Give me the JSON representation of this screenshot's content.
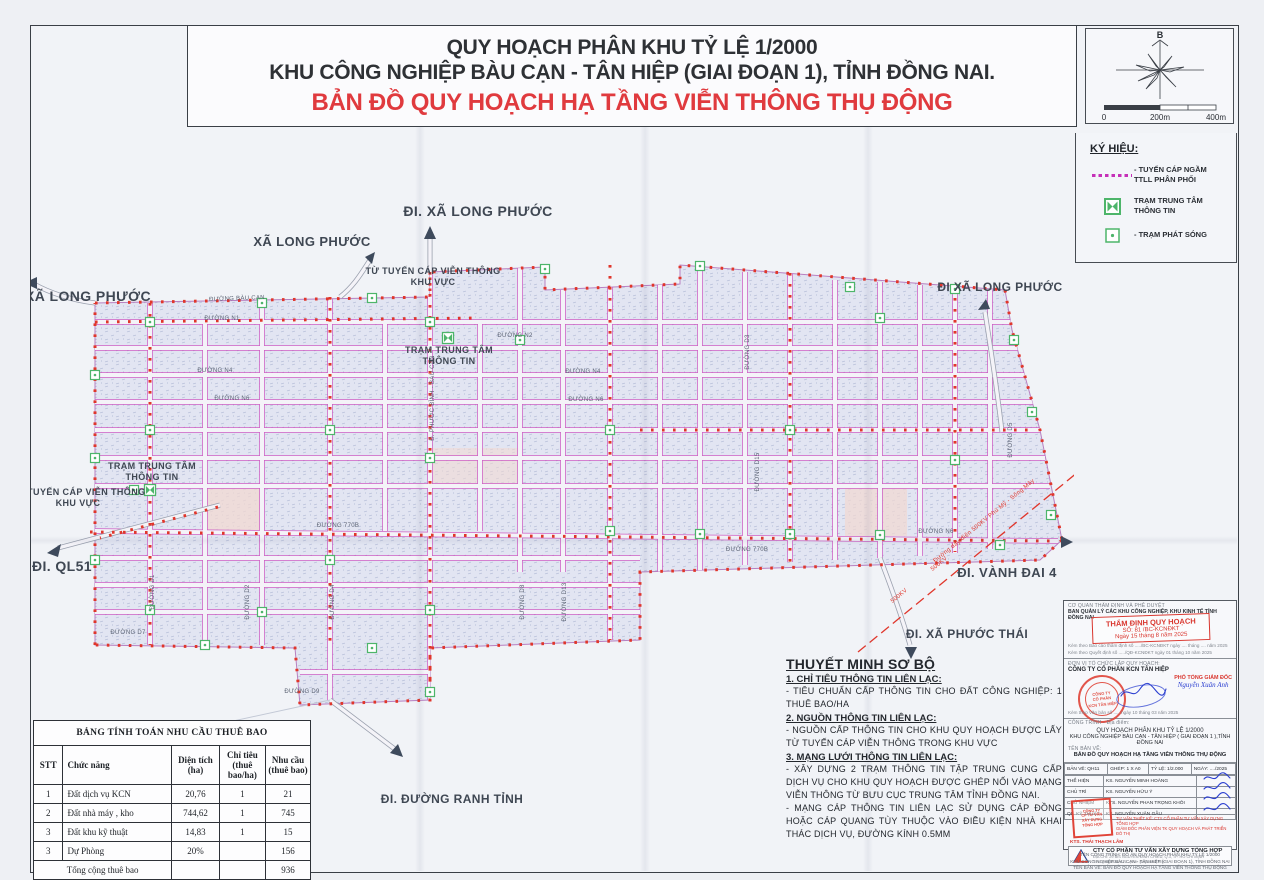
{
  "header": {
    "line1": "QUY HOẠCH PHÂN KHU TỶ LỆ 1/2000",
    "line2": "KHU CÔNG NGHIỆP BÀU CẠN - TÂN HIỆP (GIAI ĐOẠN 1), TỈNH ĐỒNG NAI.",
    "line3": "BẢN ĐỒ QUY HOẠCH HẠ TẦNG VIỄN THÔNG THỤ ĐỘNG"
  },
  "compass": {
    "north": "B",
    "scale0": "0",
    "scale1": "200m",
    "scale2": "400m"
  },
  "legend": {
    "title": "KÝ HIỆU:",
    "item0": "- TUYẾN CÁP NGẦM\nTTLL PHÂN PHỐI",
    "item1": "TRẠM TRUNG TÂM\nTHÔNG TIN",
    "item2": "- TRẠM PHÁT SÓNG"
  },
  "map": {
    "labels": [
      {
        "t": "ĐI. XÃ LONG PHƯỚC"
      },
      {
        "t": "XÃ LONG PHƯỚC"
      },
      {
        "t": "XÃ LONG PHƯỚC"
      },
      {
        "t": "TỪ TUYẾN CÁP VIỄN THÔNG"
      },
      {
        "t": "KHU VỰC"
      },
      {
        "t": "TRẠM TRUNG TÂM"
      },
      {
        "t": "THÔNG TIN"
      },
      {
        "t": "TRẠM TRUNG TÂM"
      },
      {
        "t": "THÔNG TIN"
      },
      {
        "t": "TỪ TUYẾN CÁP VIỄN THÔNG"
      },
      {
        "t": "KHU VỰC"
      },
      {
        "t": "ĐI. QL51"
      },
      {
        "t": "ĐI XÃ LONG PHƯỚC"
      },
      {
        "t": "ĐI. VÀNH ĐAI 4"
      },
      {
        "t": "ĐI. XÃ PHƯỚC THÁI"
      },
      {
        "t": "ĐI. ĐƯỜNG RANH TỈNH"
      }
    ],
    "roads": [
      {
        "t": "ĐƯỜNG BÀU CẠN"
      },
      {
        "t": "ĐƯỜNG N1"
      },
      {
        "t": "ĐƯỜNG N4"
      },
      {
        "t": "ĐƯỜNG N6"
      },
      {
        "t": "ĐƯỜNG N2"
      },
      {
        "t": "ĐƯỜNG N4"
      },
      {
        "t": "ĐƯỜNG N6"
      },
      {
        "t": "ĐƯỜNG 770B"
      },
      {
        "t": "ĐƯỜNG 770B"
      },
      {
        "t": "ĐƯỜNG N6"
      },
      {
        "t": "ĐƯỜNG D7"
      },
      {
        "t": "ĐƯỜNG D9"
      },
      {
        "t": "ĐƯỜNG D1"
      },
      {
        "t": "ĐƯỜNG D2"
      },
      {
        "t": "ĐƯỜNG D4"
      },
      {
        "t": "Đ. PHƯỚC BÌNH - BÀU CẠN"
      },
      {
        "t": "ĐƯỜNG D8"
      },
      {
        "t": "ĐƯỜNG D13"
      },
      {
        "t": "ĐƯỜNG D15"
      },
      {
        "t": "ĐƯỜNG D3"
      },
      {
        "t": "ĐƯỜNG D5"
      }
    ],
    "power": [
      {
        "t": "Đường dây điện 500KV Phú Mỹ - Sông Mây"
      },
      {
        "t": "500KV"
      },
      {
        "t": "500KV"
      }
    ]
  },
  "demand_table": {
    "title": "BẢNG TÍNH TOÁN NHU CẦU THUÊ BAO",
    "h0": "STT",
    "h1": "Chức năng",
    "h2": "Diện tích\n(ha)",
    "h3": "Chỉ tiêu\n(thuê\nbao/ha)",
    "h4": "Nhu cầu\n(thuê bao)",
    "rows": [
      [
        "1",
        "Đất dịch vụ KCN",
        "20,76",
        "1",
        "21"
      ],
      [
        "2",
        "Đất nhà máy , kho",
        "744,62",
        "1",
        "745"
      ],
      [
        "3",
        "Đất khu kỹ thuật",
        "14,83",
        "1",
        "15"
      ],
      [
        "3",
        "Dự Phòng",
        "20%",
        "",
        "156"
      ]
    ],
    "total_label": "Tổng cộng thuê bao",
    "total_value": "936"
  },
  "notes": {
    "title": "THUYẾT MINH SƠ BỘ",
    "s1h": "1. CHỈ TIÊU THÔNG TIN LIÊN LẠC:",
    "s1b": "- TIÊU CHUẨN CẤP THÔNG TIN CHO ĐẤT CÔNG NGHIỆP: 1 THUÊ BAO/HA",
    "s2h": "2. NGUỒN THÔNG TIN LIÊN LẠC:",
    "s2b": "- NGUỒN CẤP THÔNG TIN CHO KHU QUY HOẠCH ĐƯỢC LẤY TỪ TUYẾN CÁP VIỄN THÔNG TRONG KHU VỰC",
    "s3h": "3. MẠNG LƯỚI THÔNG TIN LIÊN LẠC:",
    "s3b1": "- XÂY DỰNG 2 TRẠM THÔNG TIN  TẬP TRUNG  CUNG CẤP DỊCH VỤ CHO KHU QUY HOẠCH ĐƯỢC GHÉP NỐI VÀO MẠNG VIỄN THÔNG TỪ BƯU CỤC TRUNG TÂM TỈNH ĐỒNG NAI.",
    "s3b2": "- MẠNG CÁP THÔNG TIN LIÊN LẠC SỬ DỤNG CÁP ĐỒNG HOẶC CÁP QUANG TÙY THUỘC VÀO ĐIỀU KIỆN NHÀ KHAI THÁC DỊCH VỤ, ĐƯỜNG KÍNH 0.5MM"
  },
  "title_block": {
    "approver_caption": "CƠ QUAN THẨM ĐỊNH VÀ PHÊ DUYỆT",
    "approver_name": "BAN QUẢN LÝ CÁC KHU CÔNG NGHIỆP, KHU KINH TẾ TỈNH ĐỒNG NAI",
    "stamp_line1": "THẨM ĐỊNH QUY HOẠCH",
    "stamp_line2": "SỐ:  81  /BC-KCNĐKT",
    "stamp_line3": "Ngày 15 tháng 8 năm 2025",
    "note1": "Kèm theo Báo cáo thẩm định số ...../BC-KCNĐKT ngày .... tháng .... năm 2025",
    "note2": "Kèm theo Quyết định số ...../QĐ-KCNĐKT ngày 01 tháng 10 năm 2025",
    "org_caption": "ĐƠN VỊ TỔ CHỨC LẬP QUY HOẠCH:",
    "org_name": "CÔNG TY CỔ PHẦN KCN TÂN HIỆP",
    "round_stamp": "CÔNG TY\nCỔ PHẦN\nKCN TÂN HIỆP",
    "signer_title": "PHÓ TỔNG GIÁM ĐỐC",
    "signer_name": "Nguyễn Xuân Anh",
    "org_note": "Kèm theo Văn bản số ..... ngày 10 tháng 03 năm 2025",
    "project_caption": "CÔNG TRÌNH - Địa điểm:",
    "project_line1": "QUY HOẠCH PHÂN KHU TỶ LỆ 1/2000",
    "project_line2": "KHU CÔNG NGHIỆP BÀU CẠN - TÂN HIỆP ( GIAI ĐOẠN 1 ),TỈNH ĐỒNG NAI",
    "drawing_caption": "TÊN BẢN VẼ:",
    "drawing_name": "BẢN ĐỒ QUY HOẠCH HẠ TẦNG VIỄN THÔNG THỤ ĐỘNG",
    "meta0": "BẢN VẼ: QH11",
    "meta1": "GHÉP: 1 X A0",
    "meta2": "TỶ LỆ: 1/2.000",
    "meta3": "NGÀY: ..../2025",
    "staff": [
      {
        "role": "THỂ HIỆN",
        "name": "KS. NGUYỄN MINH HOÀNG"
      },
      {
        "role": "CHỦ TRÌ",
        "name": "KS. NGUYỄN HỮU Ý"
      },
      {
        "role": "CHỦ NHIỆM",
        "name": "KTS. NGUYỄN PHAN TRỌNG KHÔI"
      },
      {
        "role": "QL. KỸ THUẬT",
        "name": "KS. NGUYỄN XUÂN GẪU"
      }
    ],
    "consultant_line1": "TƯ VẤN THIẾT KẾ: CTY CỔ PHẦN TƯ VẤN XÂY DỰNG TỔNG HỢP",
    "consultant_line2": "GIÁM ĐỐC PHÂN VIỆN TK QUY HOẠCH VÀ PHÁT TRIỂN ĐÔ THỊ",
    "square_stamp": "CÔNG TY\nCP TƯ VẤN\nXÂY DỰNG\nTỔNG HỢP",
    "consultant_sign": "KTS. THÁI THẠCH LÂM",
    "company_name": "CTY CỔ PHẦN TƯ VẤN XÂY DỰNG TỔNG HỢP",
    "company_addr": "ĐỊA CHỈ: 29 BIS NGUYỄN ĐÌNH CHIỂU, Q.3, TP. HỒ CHÍ MINH",
    "company_tel": "TEL: (08)38242471 - FAX: (08)38242723",
    "footer1": "TÊN CÔNG TRÌNH: ĐỒ ÁN QUY HOẠCH PHÂN KHU TỶ LỆ 1/2000",
    "footer2": "KHU CÔNG NGHIỆP BÀU CẠN - TÂN HIỆP (GIAI ĐOẠN 1), TỈNH ĐỒNG NAI",
    "footer3": "TÊN BẢN VẼ: BẢN ĐỒ QUY HOẠCH HẠ TẦNG VIỄN THÔNG THỤ ĐỘNG"
  },
  "colors": {
    "accent_red": "#e03a3e",
    "cable_red": "#e0362b",
    "road_magenta": "#cf5fc4",
    "station_green": "#4db56a",
    "stamp_red": "#d9362e",
    "signature_blue": "#2b3fd0"
  }
}
